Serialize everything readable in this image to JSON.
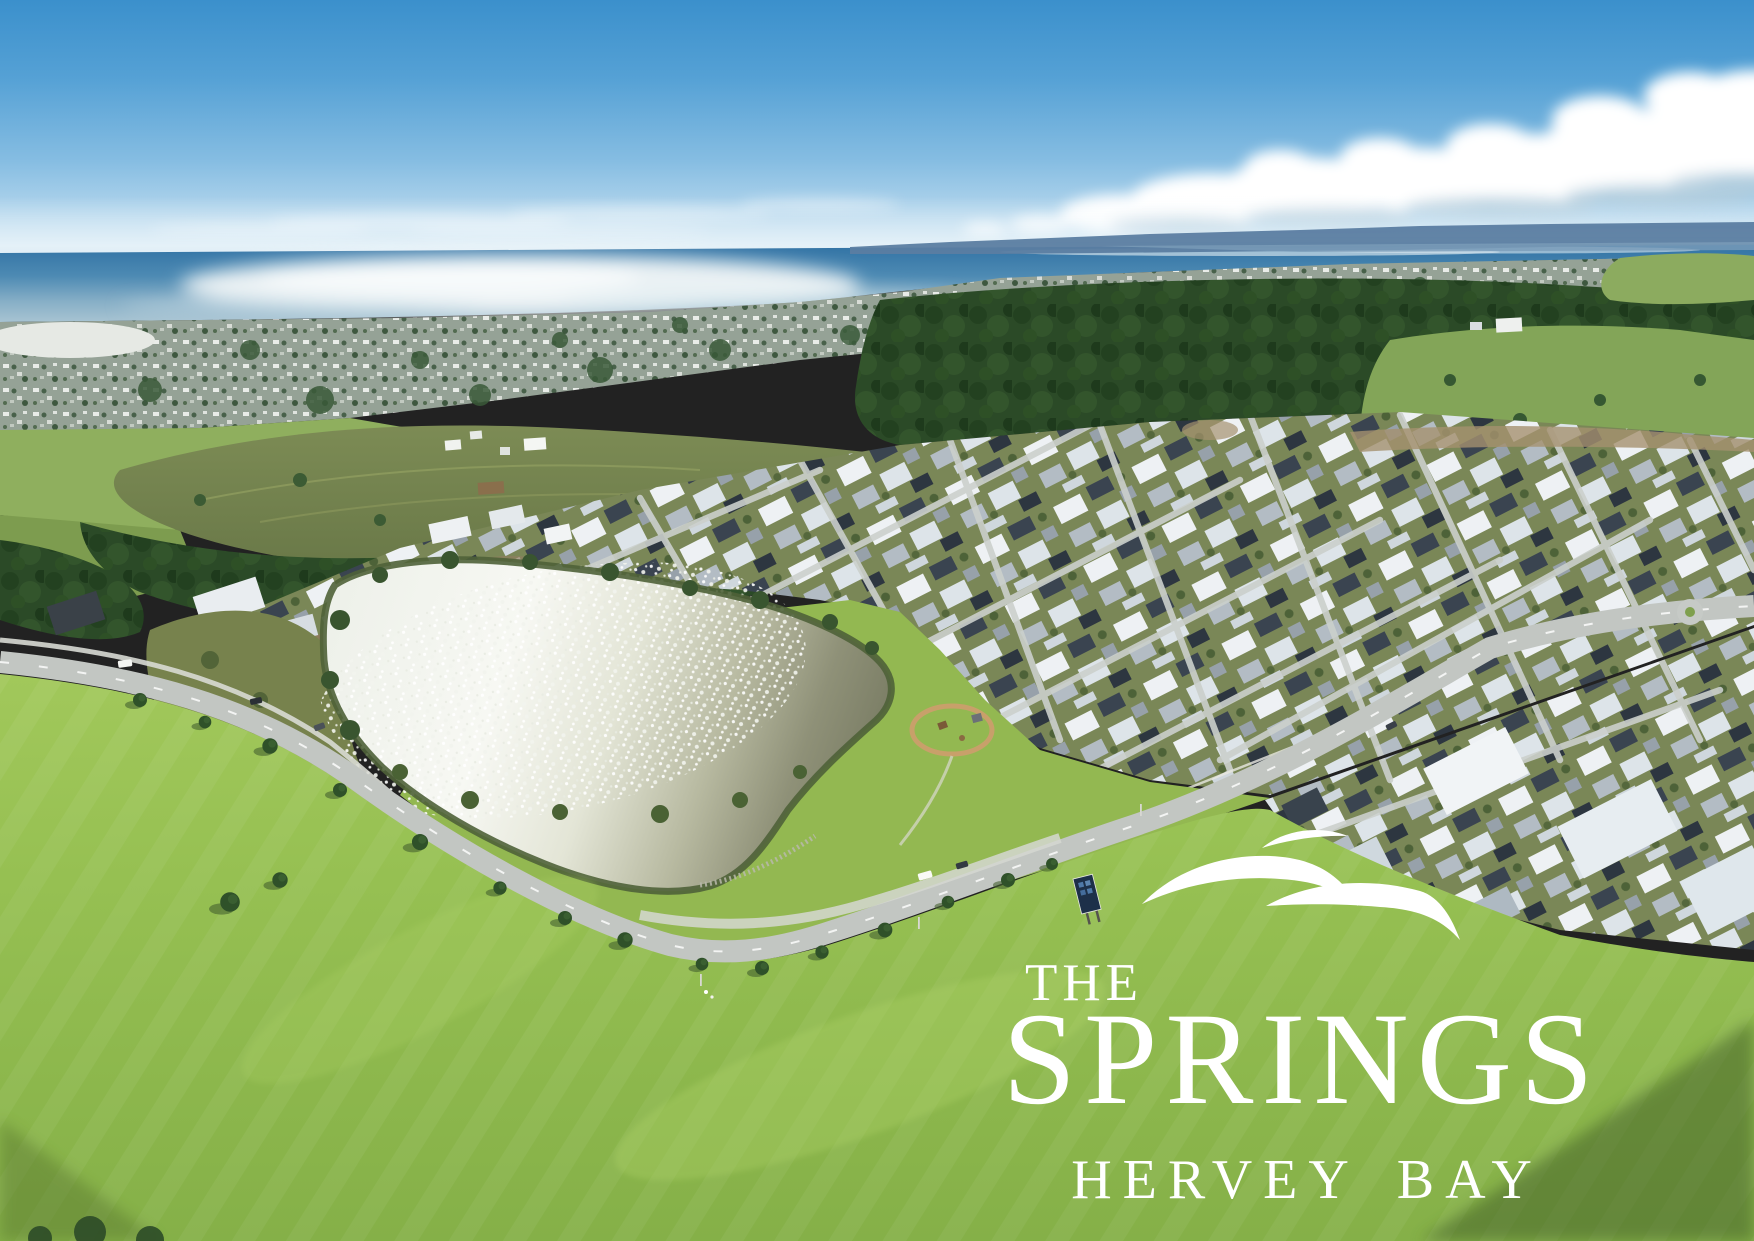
{
  "logo": {
    "the": "THE",
    "name": "SPRINGS",
    "place": "HERVEY BAY",
    "icon": "triple-wave-icon",
    "text_color": "#ffffff"
  },
  "palette": {
    "sky_top": "#3b90cc",
    "sky_horizon": "#d7eaf5",
    "ocean": "#2b6da1",
    "sun_glint": "#f2f7f8",
    "distant_land": "#5b7da1",
    "cloud_white": "#ffffff",
    "town_grey_green": "#95a296",
    "forest_green": "#2b4a27",
    "hill_olive": "#75834e",
    "yard_green": "#7a8757",
    "park_green": "#93b851",
    "field_green": "#97c052",
    "lake_sparkle": "#f4f6ef",
    "lake_water": "#7a7d64",
    "road_grey": "#c2c6c2",
    "roof_white": "#eef1f4",
    "roof_charcoal": "#3a4450"
  }
}
